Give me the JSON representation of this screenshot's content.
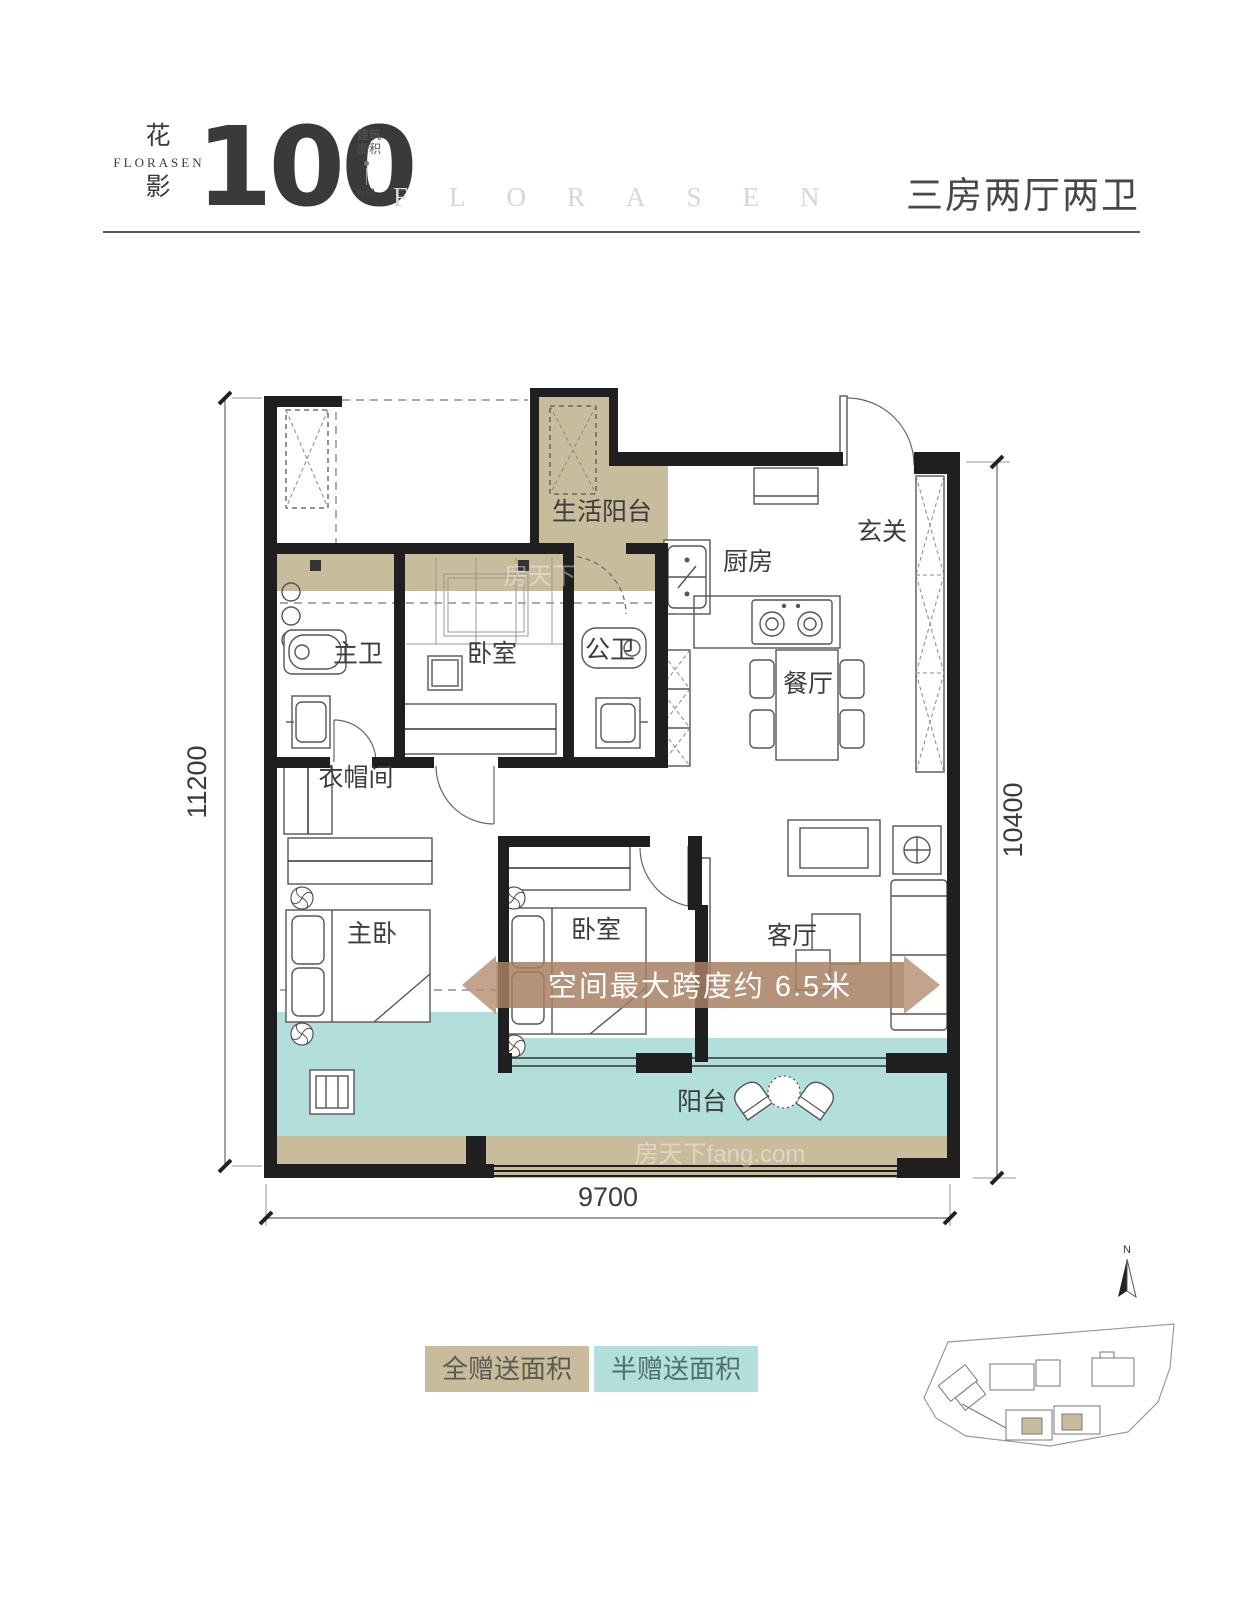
{
  "header": {
    "logo_hanzi_top": "花",
    "logo_latin": "FLORASEN",
    "logo_hanzi_bottom": "影",
    "area_value": "100",
    "area_note_top": "建筑",
    "area_note_bottom": "面积",
    "area_unit": "m²",
    "brand_letters": "FLORASEN",
    "layout_title": "三房两厅两卫"
  },
  "plan": {
    "rooms": {
      "service_balcony": "生活阳台",
      "kitchen": "厨房",
      "entry": "玄关",
      "master_bath": "主卫",
      "bedroom_top": "卧室",
      "public_bath": "公卫",
      "dining": "餐厅",
      "cloakroom": "衣帽间",
      "master_bedroom": "主卧",
      "bedroom_mid": "卧室",
      "living": "客厅",
      "balcony": "阳台"
    },
    "banner_text": "空间最大跨度约 6.5米",
    "dimensions": {
      "left": "11200",
      "right": "10400",
      "bottom": "9700"
    }
  },
  "legend": {
    "full_gift": "全赠送面积",
    "half_gift": "半赠送面积"
  },
  "compass_label": "N",
  "watermark": {
    "brand": "房天下",
    "full": "房天下fang.com"
  },
  "colors": {
    "full_gift_area": "#c9bc9c",
    "half_gift_area": "#b2dfdb",
    "banner": "#a87f63",
    "wall": "#1f1f1f",
    "text_dark": "#3b3b3b",
    "faint_brand": "#d7d7d7"
  }
}
